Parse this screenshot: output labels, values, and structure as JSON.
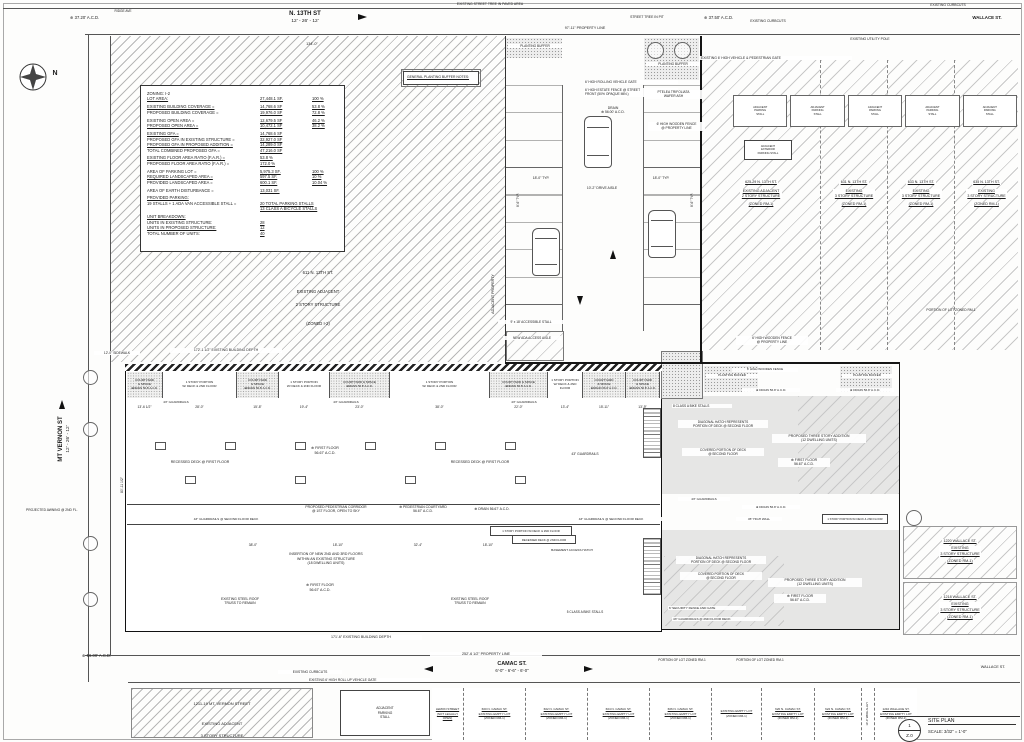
{
  "sheet": {
    "number": "1",
    "sheet_id": "Z.0",
    "title": "SITE PLAN",
    "scale": "SCALE: 3/32\" = 1'-0\""
  },
  "compass_label": "N",
  "streets": {
    "n13th_name": "N. 13TH ST",
    "n13th_dims": "12' - 26' - 12'",
    "mt_vernon_name": "MT VERNON ST",
    "mt_vernon_dims": "12' - 26' - 12'",
    "camac_name": "CAMAC ST.",
    "camac_dims": "6'-0\" - 6'-6\" - 6'-0\"",
    "wallace_top": "WALLACE ST.",
    "wallace_bottom": "WALLACE ST.",
    "ridge_ave": "RIDGE AVE"
  },
  "zoning_table": {
    "rows": [
      {
        "label": "ZONING:  I-2",
        "value": "",
        "pct": ""
      },
      {
        "label": "LOT AREA:",
        "value": "27,448.1 SF.",
        "pct": "100 %"
      },
      {
        "cls": "sp",
        "label": "EXISTING BUILDING COVERAGE =",
        "value": "14,768.6 SF",
        "pct": "53.8 %"
      },
      {
        "label": "PROPOSED BUILDING COVERAGE =",
        "value": "19,976.0 SF",
        "pct": "72.8 %"
      },
      {
        "cls": "sp",
        "label": "EXISTING OPEN AREA =",
        "value": "12,679.5 SF",
        "pct": "46.2 %"
      },
      {
        "label": "PROPOSED OPEN AREA =",
        "value": "10,472.1 SF",
        "pct": "38.2 %"
      },
      {
        "cls": "sp",
        "label": "EXISTING GFA =",
        "value": "14,768.6 SF",
        "pct": ""
      },
      {
        "label": "PROPOSED GFA IN EXISTING STRUCTURE =",
        "value": "32,927.0 SF",
        "pct": ""
      },
      {
        "label": "PROPOSED GFA IN PROPOSED ADDITION =",
        "value": "14,289.0 SF",
        "pct": ""
      },
      {
        "label": "TOTAL COMBINED PROPOSED GFA =",
        "value": "47,216.0 SF",
        "pct": ""
      },
      {
        "cls": "sp",
        "label": "EXISTING FLOOR AREA RATIO (F.A.R.) =",
        "value": "53.8  %",
        "pct": ""
      },
      {
        "label": "PROPOSED FLOOR AREA RATIO (F.A.R.) =",
        "value": "172.0  %",
        "pct": ""
      },
      {
        "cls": "sp",
        "label": "AREA OF PARKING LOT =",
        "value": "5,975.3  SF.",
        "pct": "100 %"
      },
      {
        "label": "REQUIRED LANDSCAPED AREA =",
        "value": "597.5  SF.",
        "pct": "10 %"
      },
      {
        "label": "PROVIDED LANDSCAPED AREA =",
        "value": "600.1  SF.",
        "pct": "10.04 %"
      },
      {
        "cls": "sp",
        "label": "AREA OF EARTH DISTURBANCE =",
        "value": "13,031 SF.",
        "pct": ""
      },
      {
        "cls": "sp",
        "label": "PROVIDED PARKING:",
        "value": "",
        "pct": ""
      },
      {
        "label": "19 STALLS + 1 ADA  VAN ACCESSIBLE STALL =",
        "value": "20 TOTAL PARKING STALLS",
        "pct": ""
      },
      {
        "label": "",
        "value": "13 CLASS A BICYCLE STALLS",
        "pct": ""
      },
      {
        "cls": "sp",
        "label": "UNIT BREAKDOWN:",
        "value": "",
        "pct": ""
      },
      {
        "label": "UNITS IN EXISTING STRUCTURE:",
        "value": "28",
        "pct": ""
      },
      {
        "label": "UNITS IN PROPOSED STRUCTURE:",
        "value": "12",
        "pct": ""
      },
      {
        "label": "TOTAL NUMBER OF UNITS:",
        "value": "40",
        "pct": ""
      }
    ]
  },
  "planting_notes": {
    "title": "GENERAL PLANTING BUFFER NOTES:",
    "bullets": [
      "- PLANTING BUFFER TO HAVE MINIMUM OF 3 SHRUBS PER 20' OF STREET FRONTAGE",
      "- MATURE SHRUBS TO BE 3' HIGH MINIMUM",
      "- ALL SHRUBS TO BE SPECIFIED FROM THE RECOMMENDED PLANTING LIST FOR OFF STREET PARKING, PROVIDED BY PCPC"
    ]
  },
  "adjacent_611": {
    "addr": "611 N. 13TH ST.",
    "l1": "EXISTING ADJACENT",
    "l2": "2 STORY STRUCTURE",
    "zone": "(ZONED I-2)"
  },
  "north_lots": [
    {
      "w": "118px",
      "a": "625-29 N. 13TH ST.",
      "b": "EXISTING ADJACENT\n2 STORY STRUCTURE",
      "z": "(ZONED RM-1)"
    },
    {
      "w": "67px",
      "a": "631 N. 13TH ST.",
      "b": "EXISTING\n3 STORY STRUCTURE",
      "z": "(ZONED RM-1)"
    },
    {
      "w": "67px",
      "a": "633 N. 13TH ST.",
      "b": "EXISTING\n3 STORY STRUCTURE",
      "z": "(ZONED RM-1)"
    },
    {
      "w": "64px",
      "a": "635 N. 13TH ST.",
      "b": "EXISTING\n3 STORY STRUCTURE",
      "z": "(ZONED RM-1)"
    }
  ],
  "adjacent_stalls": [
    {
      "t": "ADJACENT\nPARKING\nSTALL"
    },
    {
      "t": "ADJACENT\nPARKING\nSTALL"
    },
    {
      "t": "ADJACENT\nPARKING\nSTALL"
    },
    {
      "t": "ADJACENT\nPARKING\nSTALL"
    },
    {
      "t": "ADJACENT\nPARKING\nSTALL"
    }
  ],
  "exterior_stall": "ADJACENT\nEXTERIOR\nPARKING STALL",
  "wallace_bldgs": [
    {
      "a": "1220 WALLACE ST.",
      "b": "EXISTING\n3 STORY STRUCTURE",
      "z": "(ZONED RM-1)"
    },
    {
      "a": "1218 WALLACE ST.",
      "b": "EXISTING\n3 STORY STRUCTURE",
      "z": "(ZONED RM-1)"
    }
  ],
  "mt_vernon_block": {
    "addr": "1211-19 MT. VERNON STREET",
    "l1": "EXISTING ADJACENT",
    "l2": "3 STORY STRUCTURE"
  },
  "adj_stall_bottom": "ADJACENT\nPARKING\nSTALL",
  "camac_lots": [
    {
      "w": "31px",
      "a": "LEMON STREET",
      "b": "(NOT LEGALLY OPEN)",
      "z": ""
    },
    {
      "w": "62px",
      "a": "600 N. CAMAC ST.",
      "b": "EXISTING EMPTY LOT",
      "z": "(ZONED RM-1)"
    },
    {
      "w": "62px",
      "a": "602 N. CAMAC ST.",
      "b": "EXISTING EMPTY LOT",
      "z": "(ZONED RM-1)"
    },
    {
      "w": "62px",
      "a": "604 N. CAMAC ST.",
      "b": "EXISTING EMPTY LOT",
      "z": "(ZONED RM-1)"
    },
    {
      "w": "62px",
      "a": "606 N. CAMAC ST.",
      "b": "EXISTING EMPTY LOT",
      "z": "(ZONED RM-1)"
    },
    {
      "w": "50px",
      "a": "",
      "b": "EXISTING EMPTY LOT",
      "z": "(ZONED RM-1)"
    },
    {
      "w": "53px",
      "a": "620 N. CAMAC ST.",
      "b": "EXISTING EMPTY LOT",
      "z": "(ZONED RM-1)"
    },
    {
      "w": "47px",
      "a": "622 N. CAMAC ST.",
      "b": "EXISTING EMPTY LOT",
      "z": "(ZONED RM-1)"
    },
    {
      "w": "13px",
      "cls": "alley",
      "a": "10'-0\" WIDE ALLEY",
      "b": "",
      "z": ""
    },
    {
      "w": "43px",
      "a": "1210 WALLACE ST.",
      "b": "EXISTING EMPTY LOT",
      "z": "(ZONED RM-1)"
    }
  ],
  "band_cells": [
    {
      "cls": "c",
      "w": "36px",
      "l1": "COURTYARD\n& SPACE",
      "drain": "⊕DRAIN 56.8' A.C.D.",
      "dim": "13'-6 1/2\""
    },
    {
      "cls": "s",
      "w": "74px",
      "l1": "1 STORY PORTION\nW/ DECK & 2ND FLOOR",
      "drain": "",
      "dim": "28'-0\""
    },
    {
      "cls": "c",
      "w": "42px",
      "l1": "COURTYARD\n& SPACE",
      "drain": "⊕DRAIN 56.8' A.C.D.",
      "dim": "15'-8\""
    },
    {
      "cls": "s",
      "w": "51px",
      "l1": "1 STORY PORTION\nW/ DECK & 2ND FLOOR",
      "drain": "",
      "dim": "19'-4\""
    },
    {
      "cls": "c",
      "w": "60px",
      "l1": "COURTYARD & SPACE",
      "drain": "⊕DRAIN 56.8' A.C.D.",
      "dim": "23'-0\""
    },
    {
      "cls": "s",
      "w": "100px",
      "l1": "1 STORY PORTION\nW/ DECK & 2ND FLOOR",
      "drain": "",
      "dim": "38'-0\""
    },
    {
      "cls": "c",
      "w": "58px",
      "l1": "COURTYARD & SPACE",
      "drain": "⊕DRAIN 56.8' A.C.D.",
      "dim": "22'-0\""
    },
    {
      "cls": "s",
      "w": "35px",
      "l1": "1 STORY PORTION\nW/ DECK & 2ND FLOOR",
      "drain": "",
      "dim": "13'-4\""
    },
    {
      "cls": "c",
      "w": "43px",
      "l1": "COURTYARD\n& SPACE",
      "drain": "⊕DRAIN 56.8' A.C.D.",
      "dim": "15'-11\""
    },
    {
      "cls": "c",
      "w": "34px",
      "l1": "COURTYARD\n& SPACE",
      "drain": "⊕DRAIN 56.8' A.C.D.",
      "dim": "13'-9\""
    }
  ],
  "ann": {
    "acd_3720": "⊕ 37.20' A.C.D.",
    "acd_3750": "⊕ 37.50' A.C.D.",
    "acd_5600": "⊕ 56.00' A.C.D.",
    "street_tree_paved": "EXISTING STREET TREE IN PAVED AREA",
    "street_tree_pit": "STREET TREE IN PIT",
    "curbcuts": "EXISTING CURBCUTS",
    "utility_pole": "EXISTING UTILITY POLE",
    "ped_gate": "EXISTING 6' HIGH VEHICLE & PEDESTRIAN GATE",
    "rollup_gate": "EXISTING 6' HIGH ROLL UP VEHICLE GATE",
    "planting_buffer": "PLANTING BUFFER",
    "rolling_gate": "6' HIGH ROLLING VEHICLE GATE",
    "estate_fence": "6' HIGH ESTATE FENCE @ STREET\nFRONT (50% OPAQUE MIN.)",
    "drain_5600": "DRAIN\n⊕ 56.00' A.C.D.",
    "ptelea": "PTELEA TRIFOLIATA\nWAFER ASH",
    "wooden_fence_pl": "6' HIGH WOODEN FENCE\n@ PROPERTY LINE",
    "wooden_fence": "6' HIGH WOODEN FENCE",
    "adjacent_property": "ADJACENT PROPERTY",
    "accessible_stall": "9' x 18' ACCESSIBLE STALL",
    "ada_aisle": "NEW ADA ACCESS AISLE",
    "guardrails": "43\" GUARDRAILS",
    "guardrails_deck": "43\" GUARDRAILS @ SECOND FLOOR DECK",
    "guardrails_2nd": "43\" GUARDRAILS @ 2ND FLOOR DECK",
    "recessed_first": "RECESSED DECK @ FIRST FLOOR",
    "first_floor": "⊕ FIRST FLOOR\n56.67' A.C.D.",
    "corridor": "PROPOSED PEDESTRIAN CORRIDOR\n@ 1ST FLOOR, OPEN TO SKY",
    "ped_courtyard": "⊕ PEDESTRIAN COURTYARD\n56.67' A.C.D.",
    "drain_5667": "⊕ DRAIN 56.67' A.C.D.",
    "drain_568": "⊕ DRAIN 56.8' A.C.D.",
    "story_portion": "1 STORY PORTION W/ DECK & 2ND FLOOR",
    "recessed_2nd": "RECESSED DECK @ 2ND FLOOR",
    "insertion": "INSERTION OF NEW 2ND AND 3RD FLOORS\nWITHIN AN EXISTING STRUCTURE\n(18 DWELLING UNITS)",
    "steel_truss": "EXISTING STEEL ROOF\nTRUSS TO REMAIN",
    "basement_hatch": "BASEMENT ACCESS HATCH",
    "bike5": "5 CLASS A BIKE STALLS",
    "bike8": "8 CLASS A BIKE STALLS",
    "diag_hatch": "DIAGONAL HATCH REPRESENTS\nPORTION OF DECK @ SECOND FLOOR",
    "covered_deck": "COVERED PORTION OF DECK\n@ SECOND FLOOR",
    "proposed_addition": "PROPOSED THREE STORY ADDITION\n(12 DWELLING UNITS)",
    "high_wall": "45\" HIGH WALL",
    "security_fence": "6' SECURITY FENCE AND GATE",
    "lot_zoned_rm1": "PORTION OF LOT ZONED RM-1",
    "awning": "PROJECTED AWNING @ 2ND FL.",
    "sidewalk": "12'-0\" SIDEWALK"
  },
  "dims": {
    "d134": "134'-0\"",
    "d97": "97'-11\" PROPERTY LINE",
    "d172": "172'-1 1/2\" EXISTING BUILDING DEPTH",
    "d171": "171'-6\" EXISTING BUILDING DEPTH",
    "d252": "252'-6 1/2\" PROPERTY LINE",
    "d18": "18'-0\" TYP.",
    "d86": "8'-6\" TYP.",
    "d102": "10'-2\" DRIVE AISLE",
    "d8011": "80'-11 1/2\"",
    "c38": "38'-0\"",
    "c1810": "18'-10\"",
    "c324": "32'-4\""
  }
}
